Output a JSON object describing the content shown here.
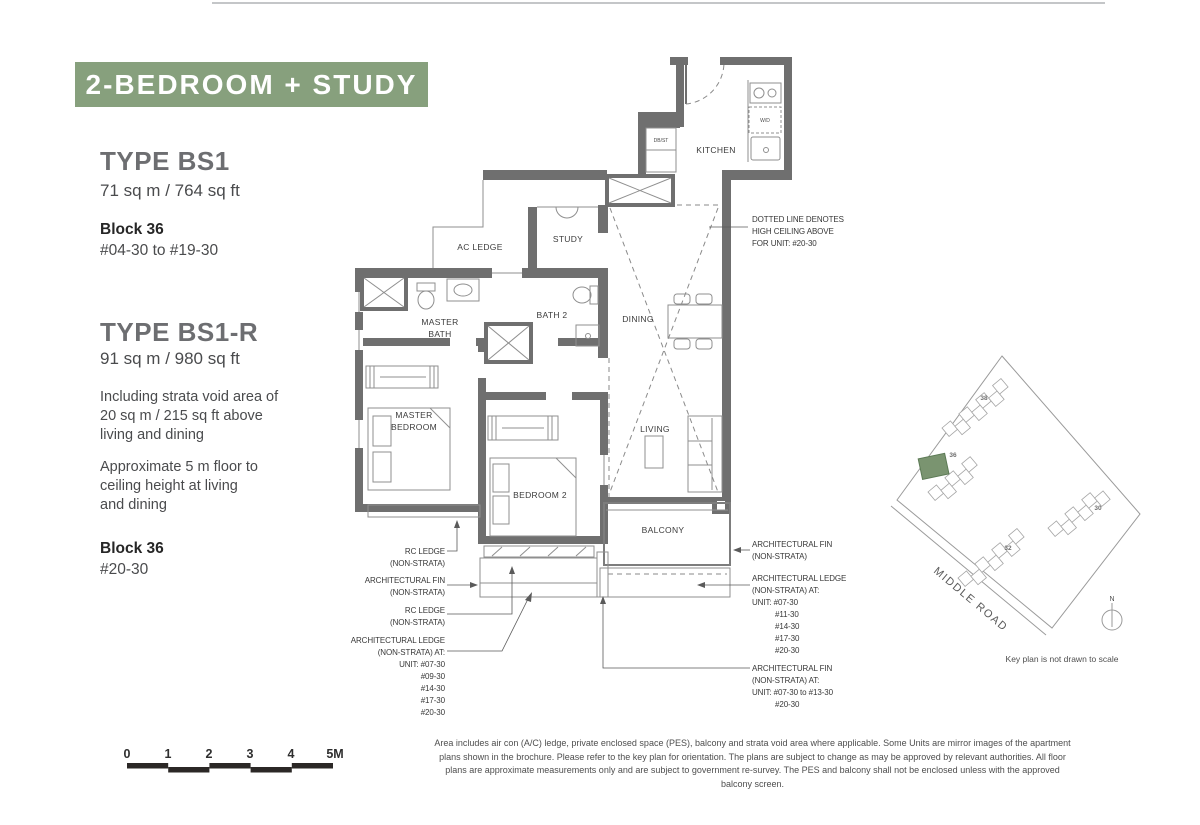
{
  "header": {
    "banner": "2-BEDROOM + STUDY"
  },
  "left_panel": {
    "type1": {
      "name": "TYPE BS1",
      "area": "71 sq m / 764 sq ft",
      "block": "Block 36",
      "units": "#04-30 to #19-30"
    },
    "type2": {
      "name": "TYPE BS1-R",
      "area": "91 sq m / 980 sq ft",
      "note1": [
        "Including strata void area of",
        "20 sq m / 215 sq ft  above",
        "living and dining"
      ],
      "note2": [
        "Approximate 5 m floor to",
        "ceiling height at living",
        "and dining"
      ],
      "block": "Block 36",
      "units": "#20-30"
    }
  },
  "floorplan": {
    "rooms": {
      "kitchen": "KITCHEN",
      "dbst": "DB/ST",
      "wd": "W/D",
      "study": "STUDY",
      "ac_ledge": "AC LEDGE",
      "master_bath": [
        "MASTER",
        "BATH"
      ],
      "bath2": "BATH 2",
      "dining": "DINING",
      "master_bedroom": [
        "MASTER",
        "BEDROOM"
      ],
      "bedroom2": "BEDROOM 2",
      "living": "LIVING",
      "balcony": "BALCONY"
    },
    "annotations": {
      "dotted_note": [
        "DOTTED LINE DENOTES",
        "HIGH CEILING ABOVE",
        "FOR UNIT: #20-30"
      ],
      "left": {
        "rc_ledge_1": [
          "RC LEDGE",
          "(NON-STRATA)"
        ],
        "arch_fin": [
          "ARCHITECTURAL FIN",
          "(NON-STRATA)"
        ],
        "rc_ledge_2": [
          "RC LEDGE",
          "(NON-STRATA)"
        ],
        "arch_ledge": [
          "ARCHITECTURAL LEDGE",
          "(NON-STRATA) AT:",
          "UNIT: #07-30",
          "#09-30",
          "#14-30",
          "#17-30",
          "#20-30"
        ]
      },
      "right": {
        "arch_fin_1": [
          "ARCHITECTURAL FIN",
          "(NON-STRATA)"
        ],
        "arch_ledge": [
          "ARCHITECTURAL LEDGE",
          "(NON-STRATA) AT:",
          "UNIT: #07-30",
          "#11-30",
          "#14-30",
          "#17-30",
          "#20-30"
        ],
        "arch_fin_2": [
          "ARCHITECTURAL FIN",
          "(NON-STRATA) AT:",
          "UNIT: #07-30 to #13-30",
          "#20-30"
        ]
      }
    }
  },
  "keyplan": {
    "blocks": [
      "38",
      "36",
      "30",
      "32"
    ],
    "road": "MIDDLE ROAD",
    "compass_n": "N",
    "caption": "Key plan is not drawn to scale"
  },
  "scalebar": {
    "labels": [
      "0",
      "1",
      "2",
      "3",
      "4",
      "5M"
    ]
  },
  "disclaimer": "Area includes air con (A/C) ledge, private enclosed space (PES), balcony and strata void area where applicable. Some Units are mirror images of the apartment plans shown in the brochure. Please refer to the key plan for orientation. The plans are subject to change as may be approved by relevant authorities. All floor plans are approximate measurements only and are subject to government re-survey. The PES and balcony shall not be enclosed unless with the approved balcony screen.",
  "colors": {
    "banner_green": "#87a07d",
    "keyplan_green": "#7a9470",
    "wall_gray": "#6f6f6f"
  }
}
